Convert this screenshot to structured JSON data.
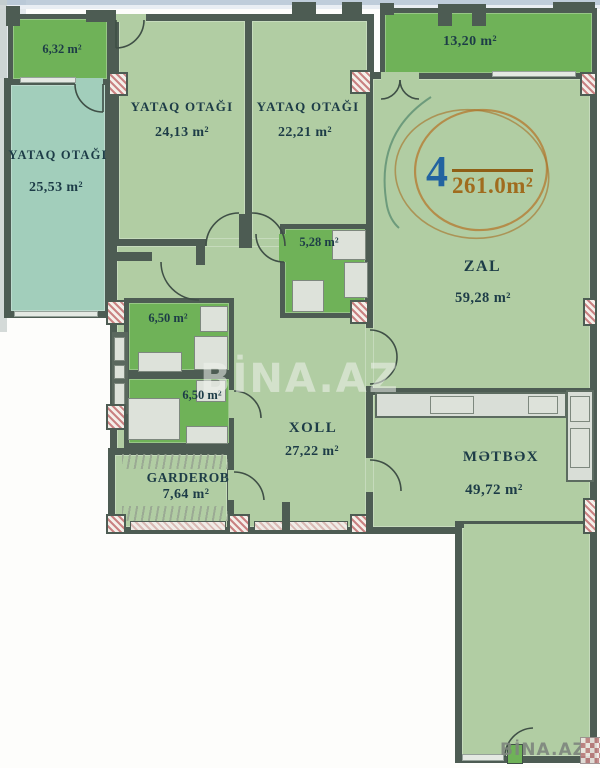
{
  "photo": {
    "center_watermark": "BİNA.AZ",
    "corner_watermark": "BİNA.AZ"
  },
  "annotation": {
    "unit_number": "4",
    "total_area": "261.0m²"
  },
  "rooms": {
    "balcony_left": {
      "area": "6,32 m²"
    },
    "balcony_right": {
      "area": "13,20 m²"
    },
    "bedroom_left": {
      "name": "YATAQ OTAĞI",
      "area": "25,53 m²"
    },
    "bedroom_middle": {
      "name": "YATAQ OTAĞI",
      "area": "24,13 m²"
    },
    "bedroom_right": {
      "name": "YATAQ OTAĞI",
      "area": "22,21 m²"
    },
    "bathroom_small": {
      "area": "5,28 m²"
    },
    "bathroom_upper": {
      "area": "6,50 m²"
    },
    "bathroom_lower": {
      "area": "6,50 m²"
    },
    "garderob": {
      "name": "GARDEROB",
      "area": "7,64 m²"
    },
    "hall": {
      "name": "XOLL",
      "area": "27,22 m²"
    },
    "living_room": {
      "name": "ZAL",
      "area": "59,28 m²"
    },
    "kitchen": {
      "name": "MƏTBƏX",
      "area": "49,72 m²"
    }
  },
  "colors": {
    "wall": "#4d5c53",
    "room-green": "#b1cda3",
    "room-teal": "#a2cebb",
    "dark-green": "#6fb258",
    "label-ink": "#1d3c47",
    "circle-orange": "#b5813b",
    "number-blue": "#2263a0",
    "area-brown": "#a06c1e",
    "furniture": "#dde2da",
    "hatch-pink": "#c98282",
    "scan-blue": "#afc0d2"
  }
}
